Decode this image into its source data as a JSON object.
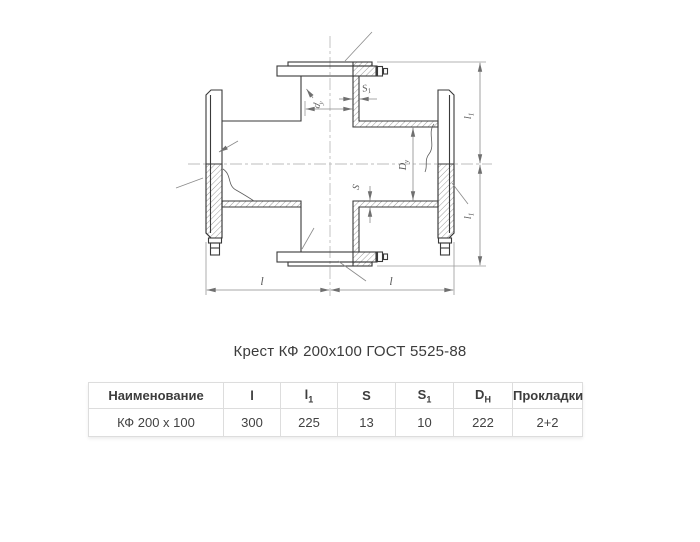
{
  "caption": {
    "text": "Крест КФ 200х100 ГОСТ 5525-88"
  },
  "drawing": {
    "labels": {
      "l_left": {
        "base": "l",
        "sub": ""
      },
      "l_right": {
        "base": "l",
        "sub": ""
      },
      "l1_top": {
        "base": "l",
        "sub": "1"
      },
      "l1_bottom": {
        "base": "l",
        "sub": "1"
      },
      "s": {
        "base": "S",
        "sub": ""
      },
      "s1": {
        "base": "S",
        "sub": "1"
      },
      "d_small": {
        "base": "d",
        "sub": "у"
      },
      "d_big": {
        "base": "D",
        "sub": "у"
      }
    },
    "colors": {
      "outline": "#3a3a3a",
      "dimension": "#8a8a8a",
      "centerline": "#bdbdbd",
      "hatch": "#6f6f6f",
      "label": "#5a5a5a"
    }
  },
  "table": {
    "columns": [
      {
        "base": "Наименование",
        "sub": ""
      },
      {
        "base": "l",
        "sub": ""
      },
      {
        "base": "l",
        "sub": "1"
      },
      {
        "base": "S",
        "sub": ""
      },
      {
        "base": "S",
        "sub": "1"
      },
      {
        "base": "D",
        "sub": "Н"
      },
      {
        "base": "Прокладки",
        "sub": ""
      }
    ],
    "rows": [
      [
        "КФ 200 х 100",
        "300",
        "225",
        "13",
        "10",
        "222",
        "2+2"
      ]
    ],
    "border_color": "#dddddd",
    "text_color": "#424242"
  }
}
